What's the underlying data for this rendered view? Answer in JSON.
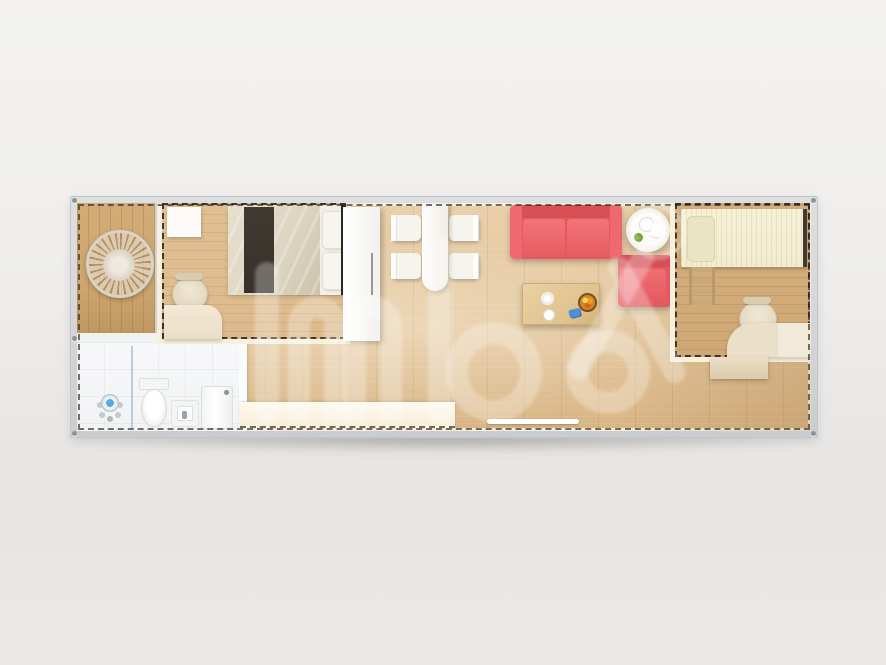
{
  "meta": {
    "kind": "3d-rendered floor plan, top-down view",
    "subject": "single-module container tiny home"
  },
  "watermark": {
    "registered_mark": "R",
    "style": "large translucent white logo glyphs over the floor"
  },
  "colors": {
    "frame": "#d3d5d7",
    "wall_cream": "#f7efdc",
    "wall_dash": "#3f372d",
    "floor_living": "#e2c49a",
    "floor_porch": "#cda671",
    "floor_bedroom": "#dcba8c",
    "floor_kid": "#cfa877",
    "bathroom_tile": "#f2f3f4",
    "sofa_red": "#e7585e",
    "armchair_red": "#e25a60",
    "bed_duvet": "#ddd6c2",
    "bed_runner": "#37312a",
    "kid_bed": "#f2ecd0",
    "furniture_beige": "#e9dfc9",
    "coffee_table": "#dfc28e",
    "watermark": "rgba(255,255,255,0.30)"
  },
  "rooms": [
    {
      "name": "porch",
      "items": [
        "hanging egg chair"
      ]
    },
    {
      "name": "bathroom",
      "items": [
        "shower set",
        "glass screen",
        "toilet",
        "floor sink",
        "washing machine"
      ]
    },
    {
      "name": "master-bedroom",
      "items": [
        "double bed with dark runner",
        "bedside cabinet",
        "desk",
        "chair"
      ]
    },
    {
      "name": "living-dining",
      "items": [
        "wardrobe",
        "dining table",
        "four white chairs",
        "red two-seat sofa",
        "red armchair",
        "round side table",
        "coffee table with fruit bowl",
        "kitchen counter",
        "entrance threshold"
      ]
    },
    {
      "name": "kids-bedroom",
      "items": [
        "single bed",
        "ladder",
        "desk",
        "chair",
        "storage cabinet"
      ]
    }
  ]
}
